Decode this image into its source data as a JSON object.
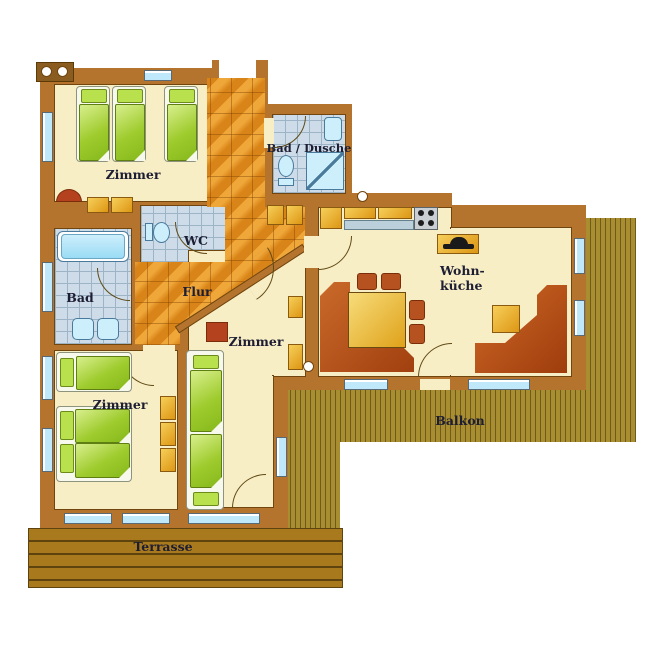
{
  "title": "Apartment floor plan",
  "labels": {
    "room_top_left": "Zimmer",
    "bath_shower": "Bad / Dusche",
    "wc": "WC",
    "hallway": "Flur",
    "bath": "Bad",
    "living_kitchen_line1": "Wohn-",
    "living_kitchen_line2": "küche",
    "room_middle": "Zimmer",
    "room_bottom_left": "Zimmer",
    "balcony": "Balkon",
    "terrace": "Terrasse"
  },
  "colors": {
    "wall": "#b5742e",
    "floor": "#f8eec6",
    "hall_tile": "#e28f1f",
    "bath_tile": "#cddce8",
    "bed_green": "#9ecb2d",
    "furniture_amber": "#e8b13a",
    "seating_rust": "#b5521f",
    "balcony_wood": "#a88d31",
    "terrace_wood": "#a9791e",
    "window_glass": "#bfe9fa",
    "label_text": "#1d1d33"
  }
}
